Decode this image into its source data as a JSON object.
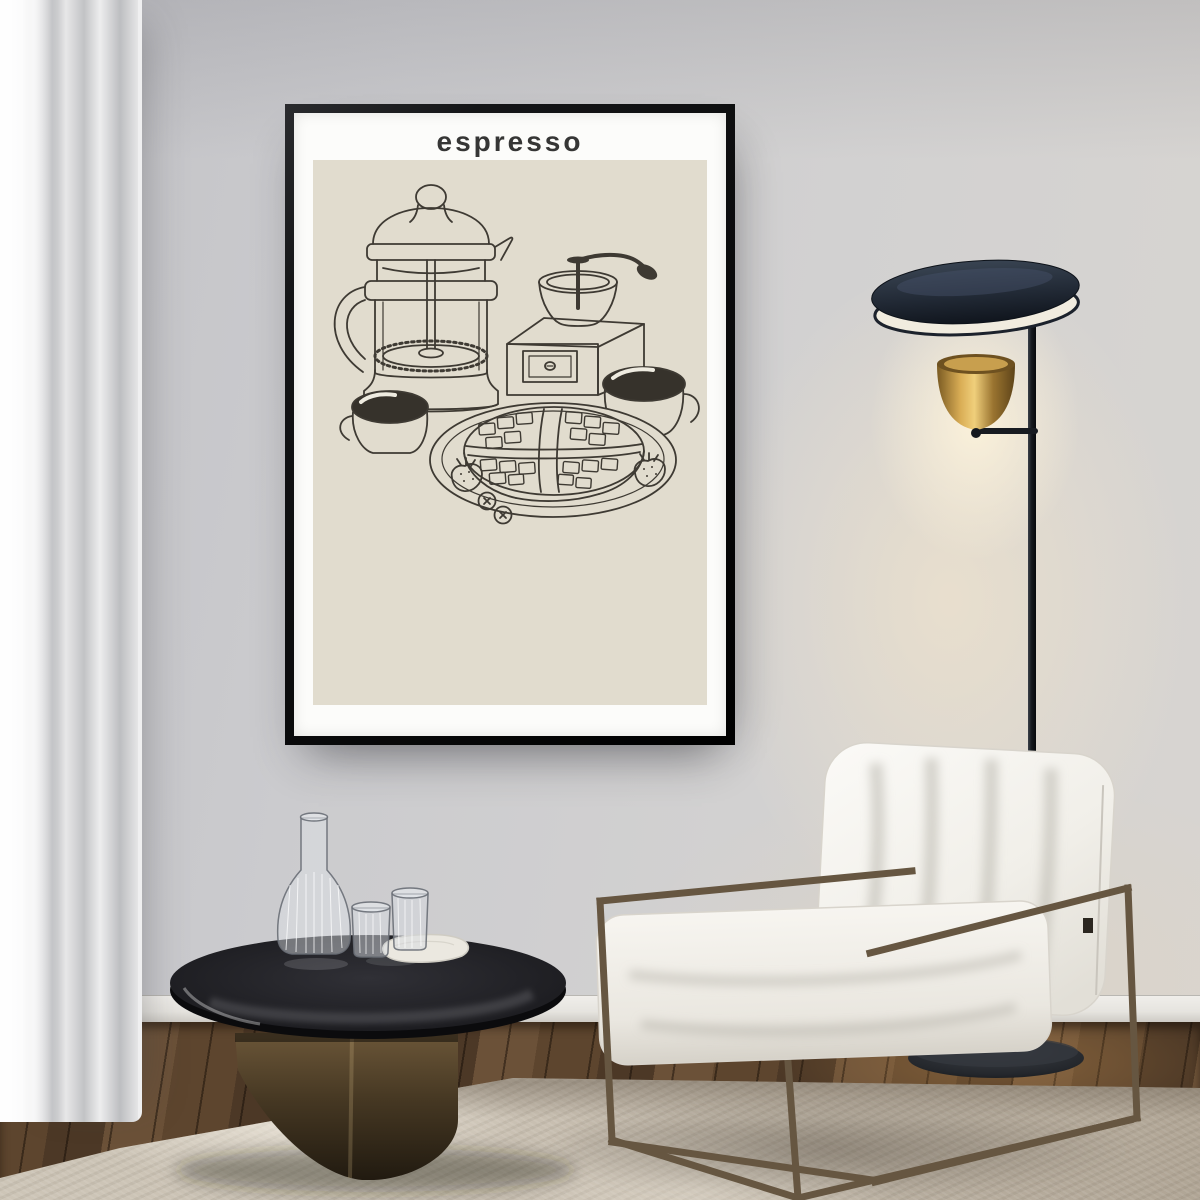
{
  "meta": {
    "description": "Interior mockup photo: black-framed espresso line-art poster on a gray wall above a modern living room with curtain, floor lamp, round coffee table and white armchair",
    "canvas": {
      "width": 1200,
      "height": 1200
    }
  },
  "poster": {
    "title": "espresso",
    "artwork_items": [
      "french-press",
      "coffee-grinder",
      "coffee-cup-left",
      "coffee-cup-right",
      "waffle-on-plate",
      "strawberry-left",
      "strawberry-right",
      "blueberries"
    ]
  },
  "room_objects": [
    "curtain",
    "wall",
    "baseboard",
    "wood-floor",
    "area-rug",
    "floor-lamp",
    "coffee-table",
    "glass-carafe",
    "glass-tumblers",
    "marble-tray",
    "armchair"
  ],
  "theme": {
    "wall": "#cccccd",
    "wall_warm_glow": "#f2e3c9",
    "curtain": "#e2e2e4",
    "baseboard": "#eceae6",
    "floor_wood": "#4a3626",
    "rug": "#c8bfb1",
    "poster_frame": "#141517",
    "poster_paper": "#fcfcfa",
    "poster_panel": "#e1dcce",
    "poster_line": "#3e3a33",
    "poster_coffee": "#36322b",
    "poster_title_color": "#363635",
    "lamp_shade": "#222a36",
    "lamp_shade_inner": "#f1ecdf",
    "lamp_brass": "#c89f4e",
    "lamp_pole": "#15181d",
    "chair_cushion": "#f3f1ec",
    "chair_frame": "#665641",
    "table_glass": "#1d1d21",
    "table_base": "#5d4a30"
  }
}
